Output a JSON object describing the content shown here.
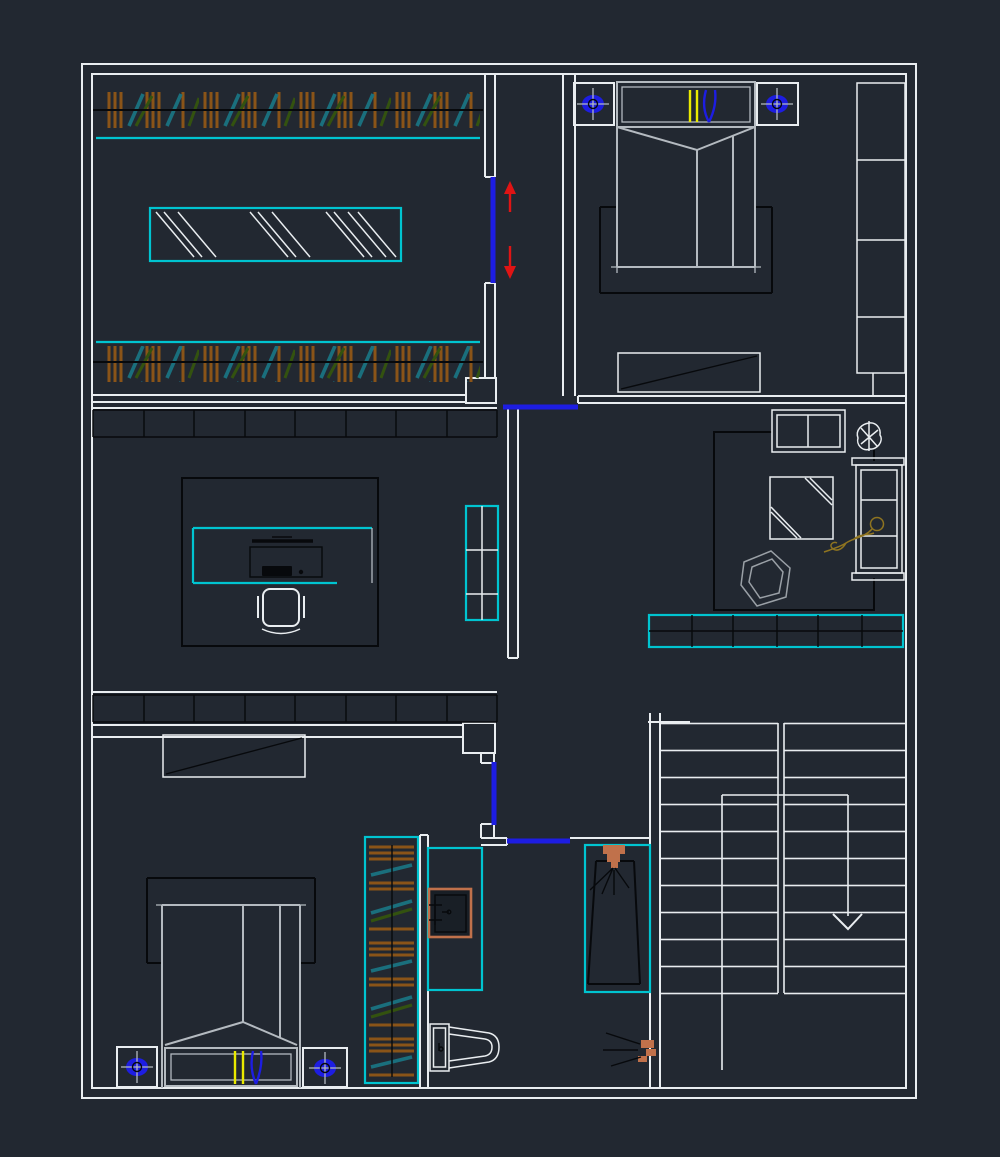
{
  "drawing": {
    "kind": "CAD apartment floor plan, dark theme, no text labels visible",
    "canvas": {
      "width": 1000,
      "height": 1157
    },
    "palette": {
      "background": "#222831",
      "wall_line": "#e9edf0",
      "furniture_line": "#b4bac0",
      "dark_line": "#07090c",
      "accent_cyan": "#00c4d0",
      "door_blue": "#1d1de2",
      "arrow_red": "#e01414",
      "accent_yellow": "#eaea00",
      "hatch_brown": "#8a5418",
      "hatch_teal": "#1a6f7d",
      "hatch_olive": "#33520f",
      "fixture_salmon": "#c0714b",
      "figure_gold": "#8f7420",
      "chair_gray": "#9aa0a6",
      "basin_fill": "#191f26"
    },
    "rooms": [
      {
        "id": "walk-in-closet",
        "position": "top-left",
        "symbols": [
          "clothes-rail-hatch-top",
          "clothes-rail-hatch-bottom",
          "island-dresser-with-glass-hatch",
          "sliding-door-with-red-arrows"
        ]
      },
      {
        "id": "bedroom-main",
        "position": "top-right",
        "symbols": [
          "double-bed-with-fold",
          "headboard-with-yellow-and-blue-marks",
          "bedside-lamp-left",
          "bedside-lamp-right",
          "dark-rug",
          "bench-with-diagonal",
          "wardrobe-column-4-sections"
        ]
      },
      {
        "id": "study",
        "position": "middle-left",
        "symbols": [
          "shelf-run-8-segments-top",
          "shelf-run-8-segments-bottom",
          "cyan-desk",
          "monitor",
          "keyboard",
          "mouse",
          "task-chair",
          "cyan-cabinet-2x3"
        ]
      },
      {
        "id": "lounge",
        "position": "middle-right",
        "symbols": [
          "two-door-cabinet",
          "plant-scribble",
          "coffee-table-striped",
          "two-seat-sofa",
          "reclining-figure-gold",
          "armchair-scribble",
          "cyan-low-shelf-6x2"
        ]
      },
      {
        "id": "bedroom-second",
        "position": "bottom-left",
        "symbols": [
          "bench-with-diagonal",
          "dark-rug",
          "double-bed-with-fold",
          "headboard-with-yellow-and-blue-marks",
          "bedside-lamp-left",
          "bedside-lamp-right",
          "wardrobe-strip-hatched"
        ]
      },
      {
        "id": "bathroom",
        "position": "bottom-middle",
        "symbols": [
          "cyan-vanity",
          "washbasin-salmon",
          "cyan-shower-with-glass",
          "shower-head-salmon-spray",
          "toilet",
          "extractor-salmon-spray"
        ]
      },
      {
        "id": "stairwell",
        "position": "bottom-right",
        "symbols": [
          "double-flight-stairs",
          "center-divider",
          "walk-line",
          "down-arrow"
        ]
      }
    ],
    "doors": [
      {
        "id": "closet-sliding-door-vertical",
        "color_key": "door_blue",
        "annotation": "red up and down slide arrows"
      },
      {
        "id": "hall-top-sliding-door-horizontal",
        "color_key": "door_blue"
      },
      {
        "id": "bedroom-second-door-vertical",
        "color_key": "door_blue"
      },
      {
        "id": "bathroom-door-horizontal",
        "color_key": "door_blue"
      }
    ],
    "counts": {
      "stair_treads_per_flight": 10,
      "office_shelf_segments": 8,
      "lounge_shelf_cells": "6 x 2",
      "wardrobe_column_sections": 4,
      "study_cabinet_grid": "2 x 3"
    }
  }
}
